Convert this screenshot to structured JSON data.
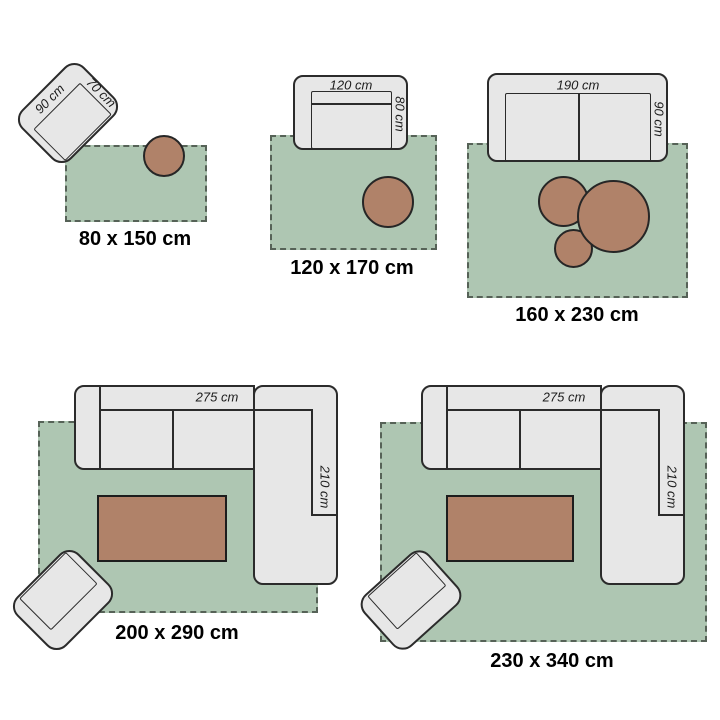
{
  "scenes": [
    {
      "title": "80 x 150 cm",
      "armchair": {
        "width_label": "90 cm",
        "depth_label": "70 cm"
      }
    },
    {
      "title": "120 x 170 cm",
      "sofa": {
        "width_label": "120 cm",
        "depth_label": "80 cm"
      }
    },
    {
      "title": "160 x 230 cm",
      "sofa": {
        "width_label": "190 cm",
        "depth_label": "90 cm"
      }
    },
    {
      "title": "200 x 290 cm",
      "sofa": {
        "width_label": "275 cm",
        "depth_label": "210 cm"
      }
    },
    {
      "title": "230 x 340 cm",
      "sofa": {
        "width_label": "275 cm",
        "depth_label": "210 cm"
      }
    }
  ],
  "colors": {
    "rug_green": "#aec6b2",
    "furniture_gray": "#e7e7e7",
    "outline_dark": "#2b2b2b",
    "wood_brown": "#b08269",
    "fringe": "#566257",
    "text": "#000000"
  }
}
